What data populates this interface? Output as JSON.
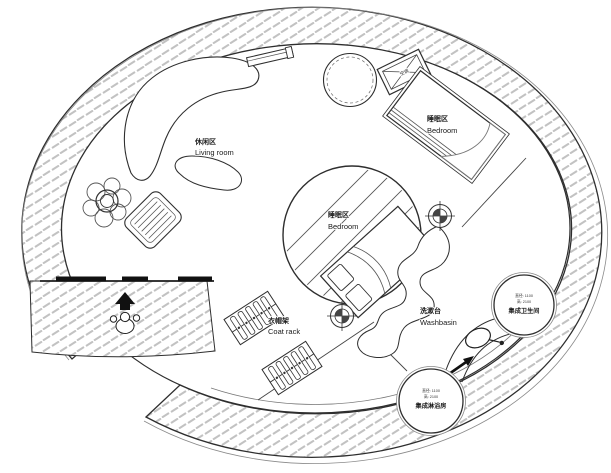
{
  "drawing": {
    "background": "#ffffff",
    "line_color": "#2e2e2e",
    "hatch_color": "#c2c2c2",
    "labels": {
      "living_room": {
        "zh": "休闲区",
        "en": "Living room"
      },
      "bedroom_upper": {
        "zh": "睡眠区",
        "en": "Bedroom"
      },
      "bedroom_center": {
        "zh": "睡眠区",
        "en": "Bedroom"
      },
      "coat_rack": {
        "zh": "衣帽架",
        "en": "Coat rack"
      },
      "washbasin": {
        "zh": "洗漱台",
        "en": "Washbasin"
      },
      "bathroom_pod": {
        "diameter": "直径: 1100",
        "height": "高: 2100",
        "name": "集成卫生间"
      },
      "shower_pod": {
        "diameter": "直径: 1100",
        "height": "高: 2100",
        "name": "集成淋浴房"
      },
      "ac_unit": {
        "zh": "空调"
      }
    }
  }
}
